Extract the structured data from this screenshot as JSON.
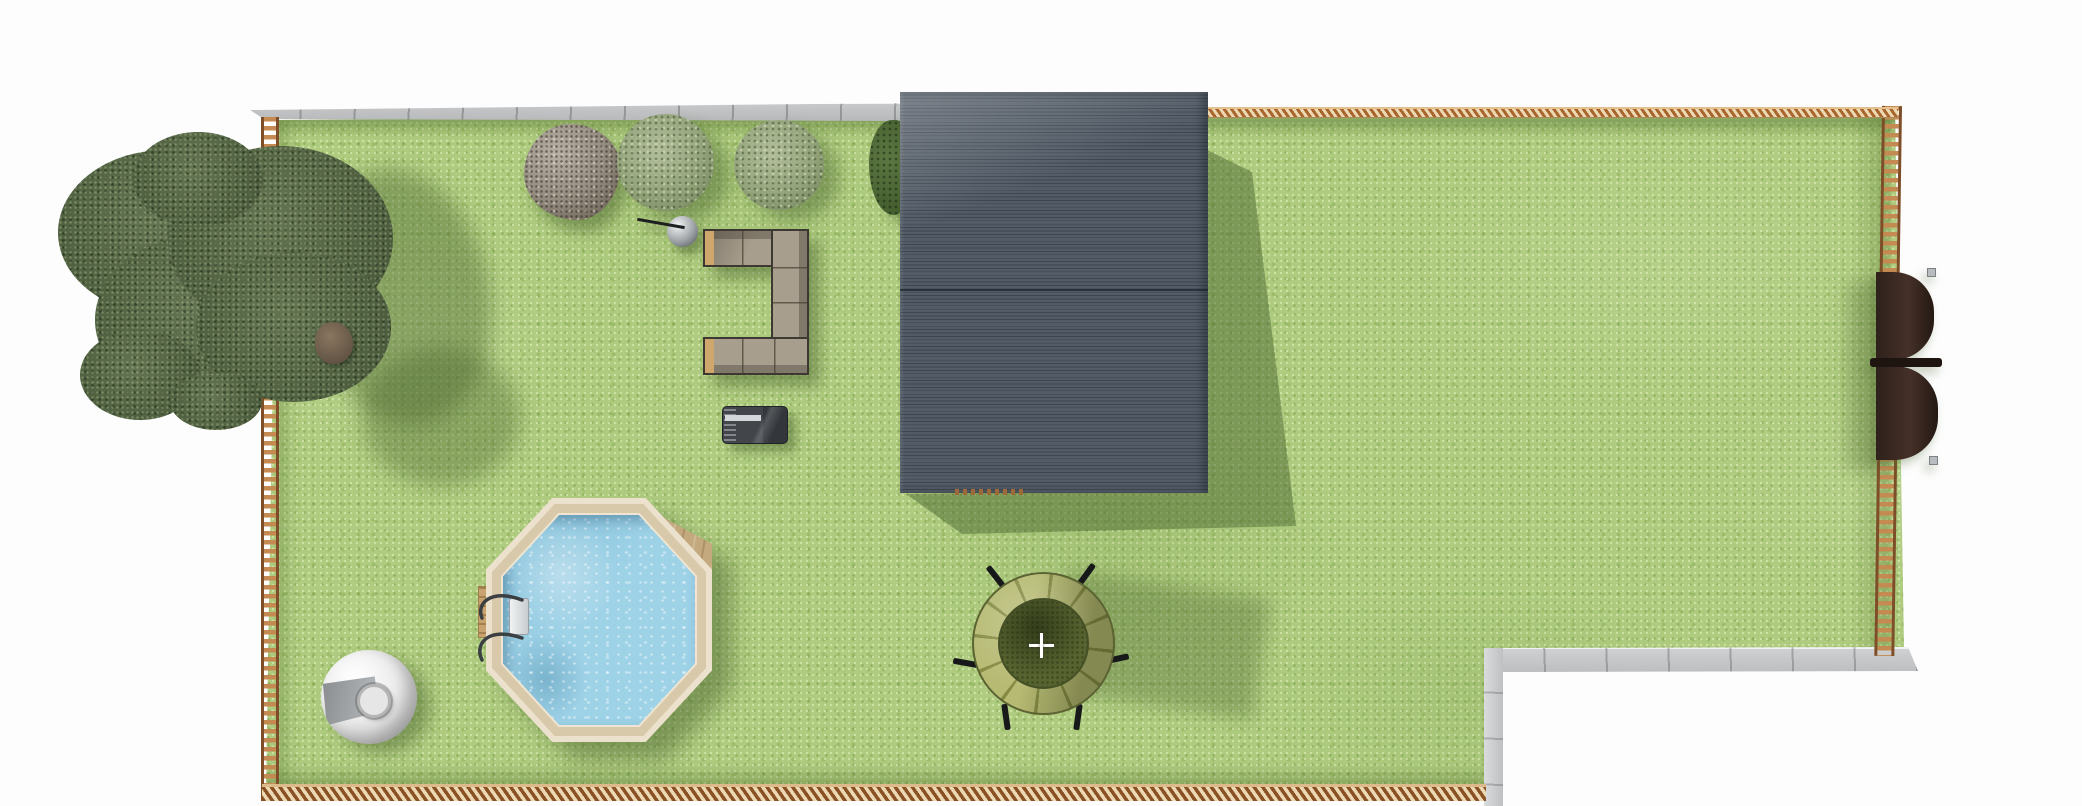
{
  "scene": {
    "title": "Backyard garden plan - top view",
    "view_mode": "top-down 3D render",
    "selection": {
      "selected_object": "trampoline",
      "marker": "crosshair"
    }
  },
  "colors": {
    "background": "#fdfdfd",
    "lawn": "#aecb7f",
    "lawn_shadow": "#7c9a50",
    "fence_wood": "#c58a52",
    "fence_rail": "#7d4e27",
    "sidewalk": "#c7c8ca",
    "roof": "#525b66",
    "roof_line": "#3d4550",
    "pool_rim": "#ece1cd",
    "pool_water": "#9ed2e7",
    "pool_deck": "#c4a97e",
    "sofa_cushion": "#a79e8d",
    "sofa_frame": "#3e3833",
    "sofa_armrest": "#cfa76c",
    "tree_canopy": "#57684a",
    "shrub": "#93a37a",
    "bush": "#466030",
    "rock": "#968d81",
    "grill_body": "#42464b",
    "grill_lid": "#d4d7da",
    "lamp": "#9da2a6",
    "trampoline_pad": "#b6ba72",
    "trampoline_mat": "#57642f",
    "ball_chair": "#ececec",
    "awning": "#241813",
    "crosshair": "#ffffff"
  },
  "objects": {
    "lawn": {
      "label": "Lawn"
    },
    "walk_top": {
      "label": "Concrete path (top)"
    },
    "walk_corner": {
      "label": "Concrete path (bottom right)"
    },
    "fence_left": {
      "label": "Wooden fence (left)"
    },
    "fence_right": {
      "label": "Wooden fence (right)"
    },
    "fence_top": {
      "label": "Wooden fence (top)"
    },
    "fence_bottom": {
      "label": "Wooden fence (bottom)"
    },
    "house": {
      "label": "House roof"
    },
    "tree": {
      "label": "Large tree"
    },
    "rock": {
      "label": "Boulder"
    },
    "shrub_a": {
      "label": "Shrub"
    },
    "shrub_b": {
      "label": "Shrub"
    },
    "bush_dark": {
      "label": "Bush"
    },
    "lamp": {
      "label": "Garden globe lamp"
    },
    "sofa": {
      "label": "Outdoor corner sofa"
    },
    "grill": {
      "label": "Barbecue grill"
    },
    "pool": {
      "label": "Octagonal above-ground pool"
    },
    "pool_deck": {
      "label": "Pool deck"
    },
    "pool_ladder": {
      "label": "Pool ladder"
    },
    "pool_step": {
      "label": "Pool outer step"
    },
    "ball_chair": {
      "label": "Sphere lounger"
    },
    "trampoline": {
      "label": "Trampoline"
    },
    "crosshair": {
      "label": "Selection crosshair"
    },
    "awning": {
      "label": "Privacy screen"
    }
  }
}
